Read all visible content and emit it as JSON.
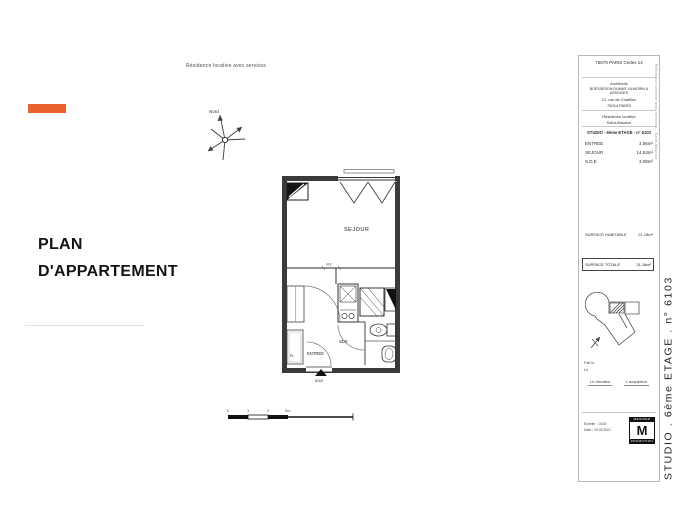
{
  "header": {
    "note": "Résidence locative avec services"
  },
  "left_panel": {
    "title_line1": "PLAN",
    "title_line2": "D'APPARTEMENT",
    "accent_color": "#E8632C"
  },
  "compass": {
    "label": "Nord"
  },
  "floor_plan": {
    "rooms": {
      "sejour": "SEJOUR",
      "entree": "ENTREE",
      "sde": "SDE",
      "placard": "PL"
    },
    "entry_label": "6103",
    "dimension": "402"
  },
  "scale_bar": {
    "ticks": [
      "0",
      "1",
      "2",
      "5m"
    ]
  },
  "title_block": {
    "cedex": "75679 PARIS Cedex 14",
    "architect_label": "Architecte",
    "architect_name": "BOESSESON DUMAS VILMORIN & ASSOCIES",
    "architect_street": "21, rue de Chatillon",
    "architect_city": "75014 PARIS",
    "residence_line1": "Résidence locative",
    "residence_line2": "Saint-Maurice",
    "unit_title": "STUDIO - 6ème ETAGE - n° 6103",
    "rooms": [
      {
        "name": "ENTREE",
        "area": "3.56m²"
      },
      {
        "name": "SEJOUR",
        "area": "14.53m²"
      },
      {
        "name": "S.D.E",
        "area": "3.09m²"
      }
    ],
    "surface_habitable": {
      "label": "SURFACE HABITABLE",
      "value": "21.18m²"
    },
    "surface_totale": {
      "label": "SURFACE TOTALE",
      "value": "21.18m²"
    },
    "fait_le": "Fait le",
    "le": "Le",
    "signature_vendeur": "Le Vendeur",
    "signature_acquereur": "L'acquéreur",
    "echelle": "Echelle : 1/100",
    "date": "Date : 19.03.2001",
    "logo": {
      "top": "MEUNIER",
      "letter": "M",
      "bottom": "PROMOTION"
    },
    "margin_note": "Résidence locative avec services - Saint-Maurice",
    "vertical_title": "STUDIO . 6ème ETAGE . n° 6103"
  }
}
